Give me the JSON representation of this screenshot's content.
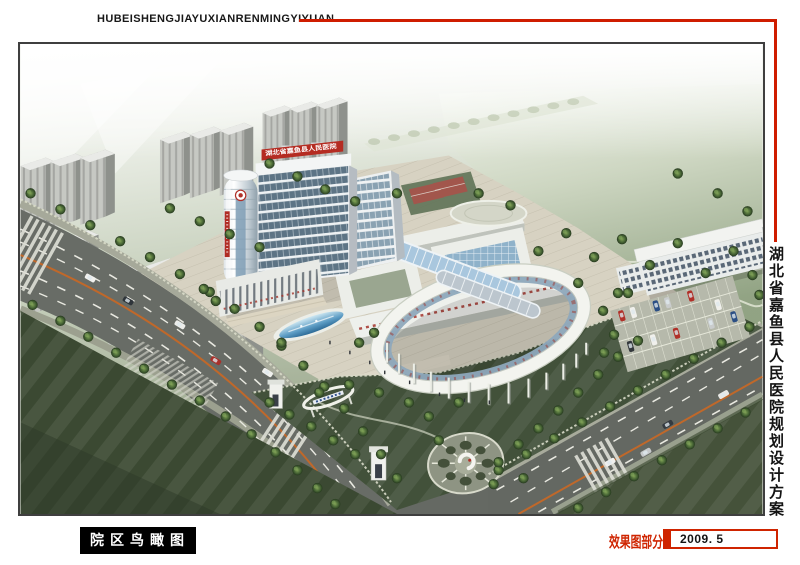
{
  "header": {
    "title": "HUBEISHENGJIAYUXIANRENMINGYIYUAN"
  },
  "side": {
    "title": "湖北省嘉鱼县人民医院规划设计方案"
  },
  "footer": {
    "view_label": "院区鸟瞰图",
    "section_label": "效果图部分",
    "date": "2009. 5"
  },
  "rendering": {
    "tower_sign": "湖北省嘉鱼县人民医院"
  },
  "colors": {
    "accent_red": "#cf1d00",
    "label_bg": "#000000",
    "label_text": "#ffffff",
    "date_text": "#141414",
    "frame_border": "#3f3f3f"
  }
}
